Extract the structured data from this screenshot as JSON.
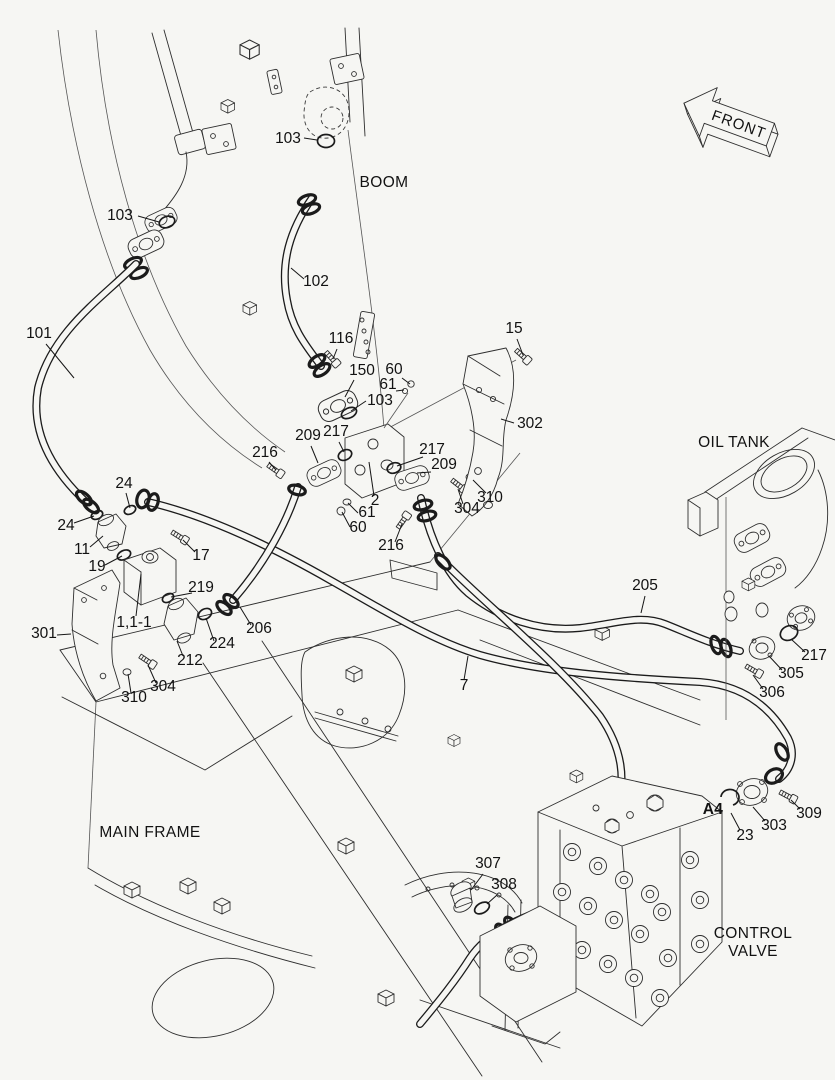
{
  "colors": {
    "background": "#f6f6f3",
    "line": "#2e2e2e",
    "hose": "#1b1b1b",
    "label": "#121212"
  },
  "front_arrow": {
    "label": "FRONT"
  },
  "region_labels": [
    {
      "id": "boom",
      "text": "BOOM",
      "x": 384,
      "y": 187
    },
    {
      "id": "oil-tank",
      "text": "OIL TANK",
      "x": 734,
      "y": 447
    },
    {
      "id": "main-frame",
      "text": "MAIN FRAME",
      "x": 150,
      "y": 837
    },
    {
      "id": "control-valve",
      "lines": [
        "CONTROL",
        "VALVE"
      ],
      "x": 753,
      "y": 938,
      "line_height": 18
    },
    {
      "id": "port-a4",
      "text": "A4",
      "x": 713,
      "y": 814,
      "bold": true
    }
  ],
  "part_labels": [
    {
      "text": "103",
      "x": 120,
      "y": 220,
      "leader": [
        138,
        216,
        159,
        222
      ]
    },
    {
      "text": "101",
      "x": 39,
      "y": 338,
      "leader": [
        46,
        344,
        74,
        378
      ]
    },
    {
      "text": "103",
      "x": 288,
      "y": 143,
      "leader": [
        304,
        138,
        317,
        140
      ]
    },
    {
      "text": "102",
      "x": 316,
      "y": 286,
      "leader": [
        304,
        279,
        291,
        268
      ]
    },
    {
      "text": "116",
      "x": 341,
      "y": 343,
      "leader": [
        337,
        349,
        333,
        359
      ]
    },
    {
      "text": "15",
      "x": 514,
      "y": 333,
      "leader": [
        517,
        339,
        523,
        355
      ]
    },
    {
      "text": "150",
      "x": 362,
      "y": 375,
      "leader": [
        354,
        380,
        345,
        397
      ]
    },
    {
      "text": "60",
      "x": 394,
      "y": 374,
      "leader": [
        402,
        378,
        410,
        384
      ]
    },
    {
      "text": "61",
      "x": 388,
      "y": 389,
      "leader": [
        396,
        391,
        404,
        390
      ]
    },
    {
      "text": "103",
      "x": 380,
      "y": 405,
      "leader": [
        366,
        401,
        351,
        411
      ]
    },
    {
      "text": "302",
      "x": 530,
      "y": 428,
      "leader": [
        514,
        423,
        501,
        419
      ]
    },
    {
      "text": "209",
      "x": 308,
      "y": 440,
      "leader": [
        311,
        446,
        318,
        463
      ]
    },
    {
      "text": "217",
      "x": 336,
      "y": 436,
      "leader": [
        339,
        442,
        344,
        452
      ]
    },
    {
      "text": "216",
      "x": 265,
      "y": 457,
      "leader": [
        269,
        462,
        276,
        470
      ]
    },
    {
      "text": "217",
      "x": 432,
      "y": 454,
      "leader": [
        423,
        457,
        397,
        466
      ]
    },
    {
      "text": "209",
      "x": 444,
      "y": 469,
      "leader": [
        431,
        472,
        417,
        473
      ]
    },
    {
      "text": "310",
      "x": 490,
      "y": 502,
      "leader": [
        486,
        493,
        473,
        480
      ]
    },
    {
      "text": "304",
      "x": 467,
      "y": 513,
      "leader": [
        463,
        504,
        458,
        489
      ]
    },
    {
      "text": "2",
      "x": 375,
      "y": 505,
      "leader": [
        374,
        496,
        369,
        462
      ]
    },
    {
      "text": "61",
      "x": 367,
      "y": 517,
      "leader": [
        358,
        513,
        348,
        503
      ]
    },
    {
      "text": "60",
      "x": 358,
      "y": 532,
      "leader": [
        350,
        527,
        342,
        512
      ]
    },
    {
      "text": "216",
      "x": 391,
      "y": 550,
      "leader": [
        395,
        542,
        402,
        524
      ]
    },
    {
      "text": "24",
      "x": 124,
      "y": 488,
      "leader": [
        126,
        493,
        130,
        508
      ]
    },
    {
      "text": "24",
      "x": 66,
      "y": 530,
      "leader": [
        74,
        523,
        94,
        516
      ]
    },
    {
      "text": "11",
      "x": 82,
      "y": 554,
      "leader": [
        90,
        547,
        103,
        536
      ]
    },
    {
      "text": "17",
      "x": 201,
      "y": 560,
      "leader": [
        195,
        552,
        183,
        540
      ]
    },
    {
      "text": "19",
      "x": 97,
      "y": 571,
      "leader": [
        105,
        565,
        122,
        556
      ]
    },
    {
      "text": "219",
      "x": 201,
      "y": 592,
      "leader": [
        192,
        593,
        171,
        597
      ]
    },
    {
      "text": "1,1-1",
      "x": 134,
      "y": 627,
      "leader": [
        136,
        616,
        141,
        574
      ]
    },
    {
      "text": "206",
      "x": 259,
      "y": 633,
      "leader": [
        251,
        625,
        240,
        607
      ]
    },
    {
      "text": "301",
      "x": 44,
      "y": 638,
      "leader": [
        57,
        635,
        71,
        634
      ]
    },
    {
      "text": "224",
      "x": 222,
      "y": 648,
      "leader": [
        214,
        641,
        206,
        618
      ]
    },
    {
      "text": "212",
      "x": 190,
      "y": 665,
      "leader": [
        183,
        656,
        177,
        641
      ]
    },
    {
      "text": "304",
      "x": 163,
      "y": 691,
      "leader": [
        156,
        683,
        148,
        665
      ]
    },
    {
      "text": "310",
      "x": 134,
      "y": 702,
      "leader": [
        131,
        693,
        128,
        674
      ]
    },
    {
      "text": "205",
      "x": 645,
      "y": 590,
      "leader": [
        645,
        596,
        641,
        613
      ]
    },
    {
      "text": "7",
      "x": 464,
      "y": 690,
      "leader": [
        464,
        680,
        468,
        656
      ]
    },
    {
      "text": "217",
      "x": 814,
      "y": 660,
      "leader": [
        805,
        652,
        791,
        639
      ]
    },
    {
      "text": "305",
      "x": 791,
      "y": 678,
      "leader": [
        782,
        670,
        769,
        656
      ]
    },
    {
      "text": "306",
      "x": 772,
      "y": 697,
      "leader": [
        763,
        689,
        753,
        675
      ]
    },
    {
      "text": "23",
      "x": 745,
      "y": 840,
      "leader": [
        740,
        830,
        731,
        813
      ]
    },
    {
      "text": "303",
      "x": 774,
      "y": 830,
      "leader": [
        765,
        821,
        753,
        807
      ]
    },
    {
      "text": "309",
      "x": 809,
      "y": 818,
      "leader": [
        800,
        809,
        791,
        800
      ]
    },
    {
      "text": "307",
      "x": 488,
      "y": 868,
      "leader": [
        483,
        874,
        471,
        890
      ]
    },
    {
      "text": "308",
      "x": 504,
      "y": 889,
      "leader": [
        497,
        895,
        487,
        904
      ]
    }
  ]
}
